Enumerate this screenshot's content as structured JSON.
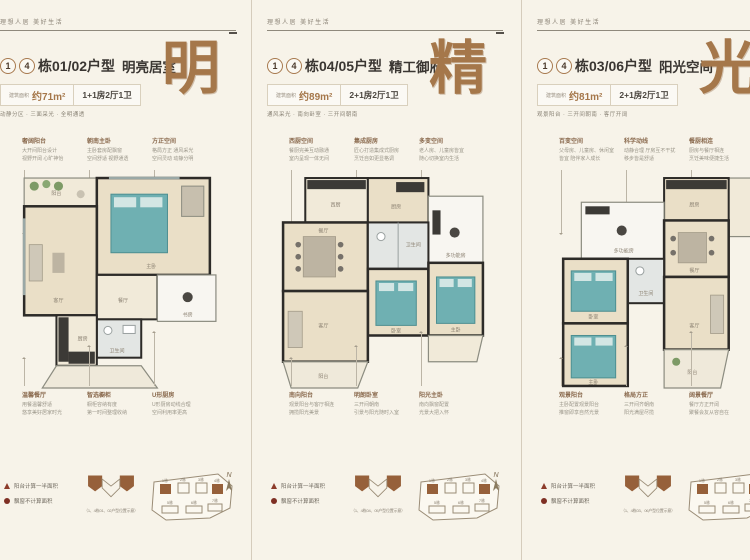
{
  "page": {
    "slogan": "理想人居 美好生活"
  },
  "legend": {
    "balcony": "阳台计算一半面积",
    "baywindow": "飘窗不计算面积",
    "compass": "N"
  },
  "siteplan": {
    "labels": [
      "1栋",
      "2栋",
      "3栋",
      "4栋",
      "5栋",
      "6栋",
      "7栋"
    ]
  },
  "panels": [
    {
      "header": {
        "num1": "1",
        "num2": "4",
        "building": "栋01/02户型",
        "subtitle": "明亮居室",
        "area_label": "建筑面积",
        "area_value": "约71m²",
        "layout": "1+1房2厅1卫",
        "features": "动静分区 · 三面采光 · 全明通透",
        "big_char": "明"
      },
      "callouts_top": [
        {
          "title": "奢阔阳台",
          "line1": "大开间阳台设计",
          "line2": "视野开阔 心旷神怡"
        },
        {
          "title": "朝南主卧",
          "line1": "主卧套房配飘窗",
          "line2": "空间舒适 视野通透"
        },
        {
          "title": "方正空间",
          "line1": "格局方正 通风采光",
          "line2": "空间灵动 动静分明"
        }
      ],
      "callouts_bottom": [
        {
          "title": "温馨餐厅",
          "line1": "用餐温馨舒适",
          "line2": "悠享美好居家时光"
        },
        {
          "title": "智选橱柜",
          "line1": "橱柜容纳有度",
          "line2": "第一时间整理收纳"
        },
        {
          "title": "U形厨房",
          "line1": "U形厨房动线合理",
          "line2": "空间利用率更高"
        }
      ],
      "rooms": [
        "阳台",
        "主卧",
        "客厅",
        "餐厅",
        "书房",
        "卫生间",
        "厨房"
      ],
      "keyplan_caption": "（1、4栋01、02户型位置示意）"
    },
    {
      "header": {
        "num1": "1",
        "num2": "4",
        "building": "栋04/05户型",
        "subtitle": "精工御府",
        "area_label": "建筑面积",
        "area_value": "约89m²",
        "layout": "2+1房2厅1卫",
        "features": "通风采光 · 南向卧室 · 三开间朝南",
        "big_char": "精"
      },
      "callouts_top": [
        {
          "title": "西厨空间",
          "line1": "餐厨完美互动融通",
          "line2": "室内呈现一体无间"
        },
        {
          "title": "集成厨房",
          "line1": "匠心打造集成式厨房",
          "line2": "烹饪自如更显格调"
        },
        {
          "title": "多变空间",
          "line1": "老人房、儿童房皆宜",
          "line2": "随心切换室内生活"
        }
      ],
      "callouts_bottom": [
        {
          "title": "南向阳台",
          "line1": "观景阳台与客厅相连",
          "line2": "拥揽阳光美景"
        },
        {
          "title": "明朗卧室",
          "line1": "三开间朝南",
          "line2": "引景与阳光随时入室"
        },
        {
          "title": "阳光主卧",
          "line1": "南向飘窗配置",
          "line2": "光景大把入怀"
        }
      ],
      "rooms": [
        "西厨",
        "厨房",
        "多功能房",
        "餐厅",
        "卫生间",
        "客厅",
        "卧室",
        "主卧",
        "阳台"
      ],
      "keyplan_caption": "（1、4栋04、05户型位置示意）"
    },
    {
      "header": {
        "num1": "1",
        "num2": "4",
        "building": "栋03/06户型",
        "subtitle": "阳光空间",
        "area_label": "建筑面积",
        "area_value": "约81m²",
        "layout": "2+1房2厅1卫",
        "features": "观景阳台 · 三开间朝南 · 客厅开阔",
        "big_char": "光"
      },
      "callouts_top": [
        {
          "title": "百变空间",
          "line1": "父母房、儿童房、休闲室",
          "line2": "皆宜 陪伴家人成长"
        },
        {
          "title": "科学动线",
          "line1": "动静合理 厅房互不干扰",
          "line2": "移步皆是舒适"
        },
        {
          "title": "餐厨相连",
          "line1": "厨房与餐厅相连",
          "line2": "烹饪美味便捷生活"
        }
      ],
      "callouts_bottom": [
        {
          "title": "观景阳台",
          "line1": "主卧配置观景阳台",
          "line2": "推窗即享自然光景"
        },
        {
          "title": "格局方正",
          "line1": "三开间齐朝南",
          "line2": "阳光满屋尽揽"
        },
        {
          "title": "阔景餐厅",
          "line1": "餐厅方正开阔",
          "line2": "聚餐会友从容自在"
        }
      ],
      "rooms": [
        "厨房",
        "多功能房",
        "餐厅",
        "卫生间",
        "卧室",
        "客厅",
        "主卧",
        "阳台"
      ],
      "keyplan_caption": "（1、4栋03、06户型位置示意）"
    }
  ]
}
